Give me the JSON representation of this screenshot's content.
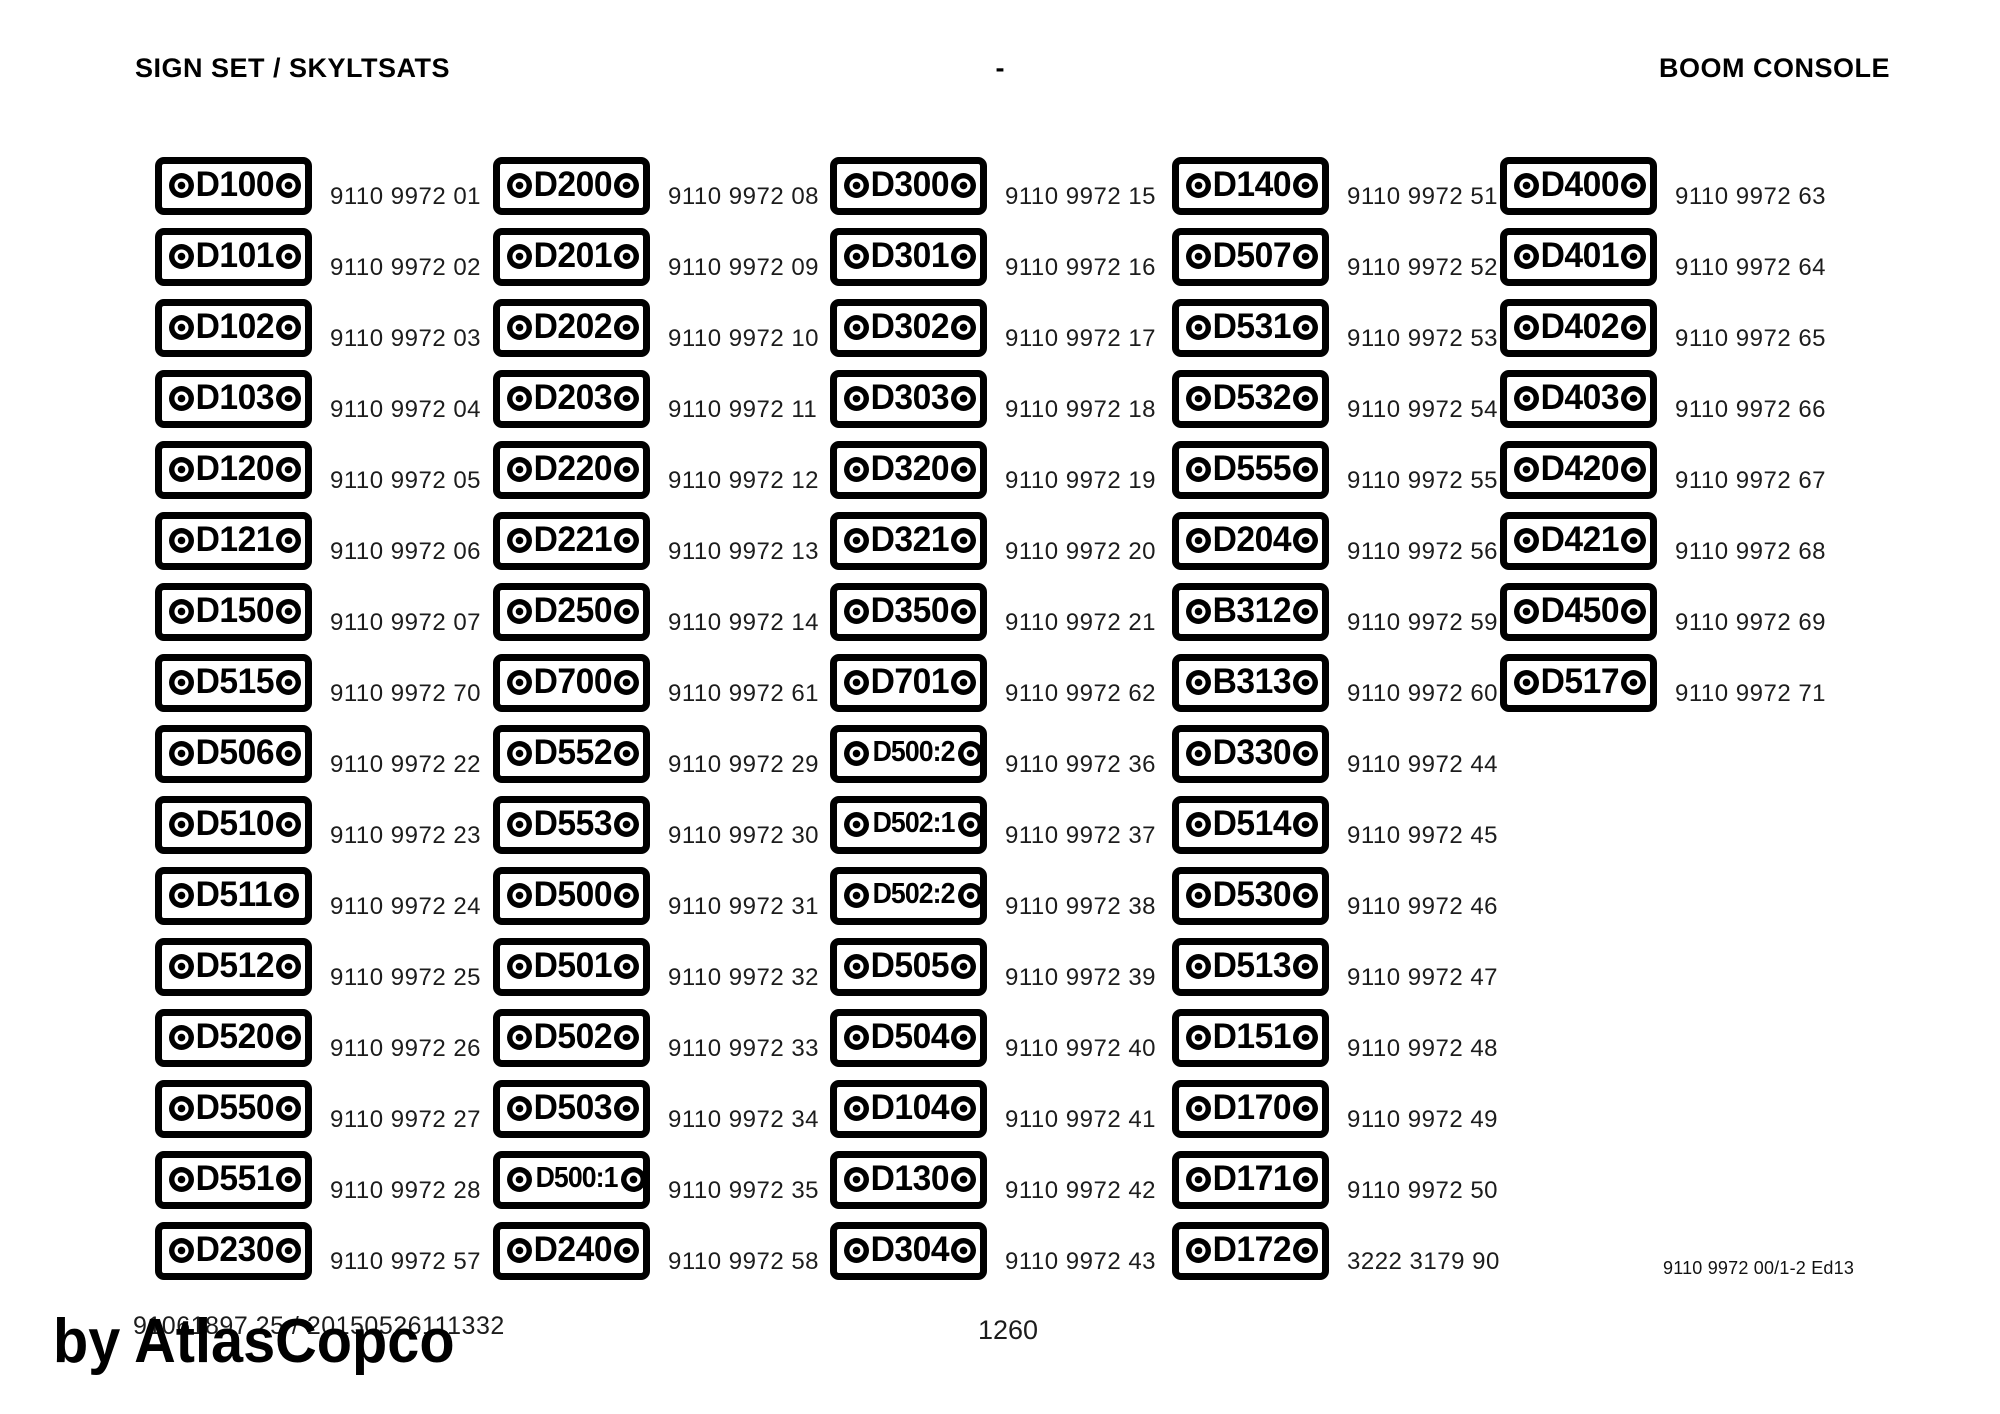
{
  "header": {
    "left": "SIGN SET / SKYLTSATS",
    "center": "-",
    "right": "BOOM CONSOLE"
  },
  "columns": [
    {
      "items": [
        {
          "label": "D100",
          "part": "9110 9972 01"
        },
        {
          "label": "D101",
          "part": "9110 9972 02"
        },
        {
          "label": "D102",
          "part": "9110 9972 03"
        },
        {
          "label": "D103",
          "part": "9110 9972 04"
        },
        {
          "label": "D120",
          "part": "9110 9972 05"
        },
        {
          "label": "D121",
          "part": "9110 9972 06"
        },
        {
          "label": "D150",
          "part": "9110 9972 07"
        },
        {
          "label": "D515",
          "part": "9110 9972 70"
        },
        {
          "label": "D506",
          "part": "9110 9972 22"
        },
        {
          "label": "D510",
          "part": "9110 9972 23"
        },
        {
          "label": "D511",
          "part": "9110 9972 24"
        },
        {
          "label": "D512",
          "part": "9110 9972 25"
        },
        {
          "label": "D520",
          "part": "9110 9972 26"
        },
        {
          "label": "D550",
          "part": "9110 9972 27"
        },
        {
          "label": "D551",
          "part": "9110 9972 28"
        },
        {
          "label": "D230",
          "part": "9110 9972 57"
        }
      ]
    },
    {
      "items": [
        {
          "label": "D200",
          "part": "9110 9972 08"
        },
        {
          "label": "D201",
          "part": "9110 9972 09"
        },
        {
          "label": "D202",
          "part": "9110 9972 10"
        },
        {
          "label": "D203",
          "part": "9110 9972 11"
        },
        {
          "label": "D220",
          "part": "9110 9972 12"
        },
        {
          "label": "D221",
          "part": "9110 9972 13"
        },
        {
          "label": "D250",
          "part": "9110 9972 14"
        },
        {
          "label": "D700",
          "part": "9110 9972 61"
        },
        {
          "label": "D552",
          "part": "9110 9972 29"
        },
        {
          "label": "D553",
          "part": "9110 9972 30"
        },
        {
          "label": "D500",
          "part": "9110 9972 31"
        },
        {
          "label": "D501",
          "part": "9110 9972 32"
        },
        {
          "label": "D502",
          "part": "9110 9972 33"
        },
        {
          "label": "D503",
          "part": "9110 9972 34"
        },
        {
          "label": "D500:1",
          "part": "9110 9972 35"
        },
        {
          "label": "D240",
          "part": "9110 9972 58"
        }
      ]
    },
    {
      "items": [
        {
          "label": "D300",
          "part": "9110 9972 15"
        },
        {
          "label": "D301",
          "part": "9110 9972 16"
        },
        {
          "label": "D302",
          "part": "9110 9972 17"
        },
        {
          "label": "D303",
          "part": "9110 9972 18"
        },
        {
          "label": "D320",
          "part": "9110 9972 19"
        },
        {
          "label": "D321",
          "part": "9110 9972 20"
        },
        {
          "label": "D350",
          "part": "9110 9972 21"
        },
        {
          "label": "D701",
          "part": "9110 9972 62"
        },
        {
          "label": "D500:2",
          "part": "9110 9972 36"
        },
        {
          "label": "D502:1",
          "part": "9110 9972 37"
        },
        {
          "label": "D502:2",
          "part": "9110 9972 38"
        },
        {
          "label": "D505",
          "part": "9110 9972 39"
        },
        {
          "label": "D504",
          "part": "9110 9972 40"
        },
        {
          "label": "D104",
          "part": "9110 9972 41"
        },
        {
          "label": "D130",
          "part": "9110 9972 42"
        },
        {
          "label": "D304",
          "part": "9110 9972 43"
        }
      ]
    },
    {
      "items": [
        {
          "label": "D140",
          "part": "9110 9972 51"
        },
        {
          "label": "D507",
          "part": "9110 9972 52"
        },
        {
          "label": "D531",
          "part": "9110 9972 53"
        },
        {
          "label": "D532",
          "part": "9110 9972 54"
        },
        {
          "label": "D555",
          "part": "9110 9972 55"
        },
        {
          "label": "D204",
          "part": "9110 9972 56"
        },
        {
          "label": "B312",
          "part": "9110 9972 59"
        },
        {
          "label": "B313",
          "part": "9110 9972 60"
        },
        {
          "label": "D330",
          "part": "9110 9972 44"
        },
        {
          "label": "D514",
          "part": "9110 9972 45"
        },
        {
          "label": "D530",
          "part": "9110 9972 46"
        },
        {
          "label": "D513",
          "part": "9110 9972 47"
        },
        {
          "label": "D151",
          "part": "9110 9972 48"
        },
        {
          "label": "D170",
          "part": "9110 9972 49"
        },
        {
          "label": "D171",
          "part": "9110 9972 50"
        },
        {
          "label": "D172",
          "part": "3222 3179 90"
        }
      ]
    },
    {
      "items": [
        {
          "label": "D400",
          "part": "9110 9972 63"
        },
        {
          "label": "D401",
          "part": "9110 9972 64"
        },
        {
          "label": "D402",
          "part": "9110 9972 65"
        },
        {
          "label": "D403",
          "part": "9110 9972 66"
        },
        {
          "label": "D420",
          "part": "9110 9972 67"
        },
        {
          "label": "D421",
          "part": "9110 9972 68"
        },
        {
          "label": "D450",
          "part": "9110 9972 69"
        },
        {
          "label": "D517",
          "part": "9110 9972 71"
        }
      ]
    }
  ],
  "footer": {
    "doc_ref": "91061897 25 / 20150526111332",
    "watermark": "by AtlasCopco",
    "page_number": "1260",
    "edition": "9110 9972 00/1-2 Ed13"
  }
}
